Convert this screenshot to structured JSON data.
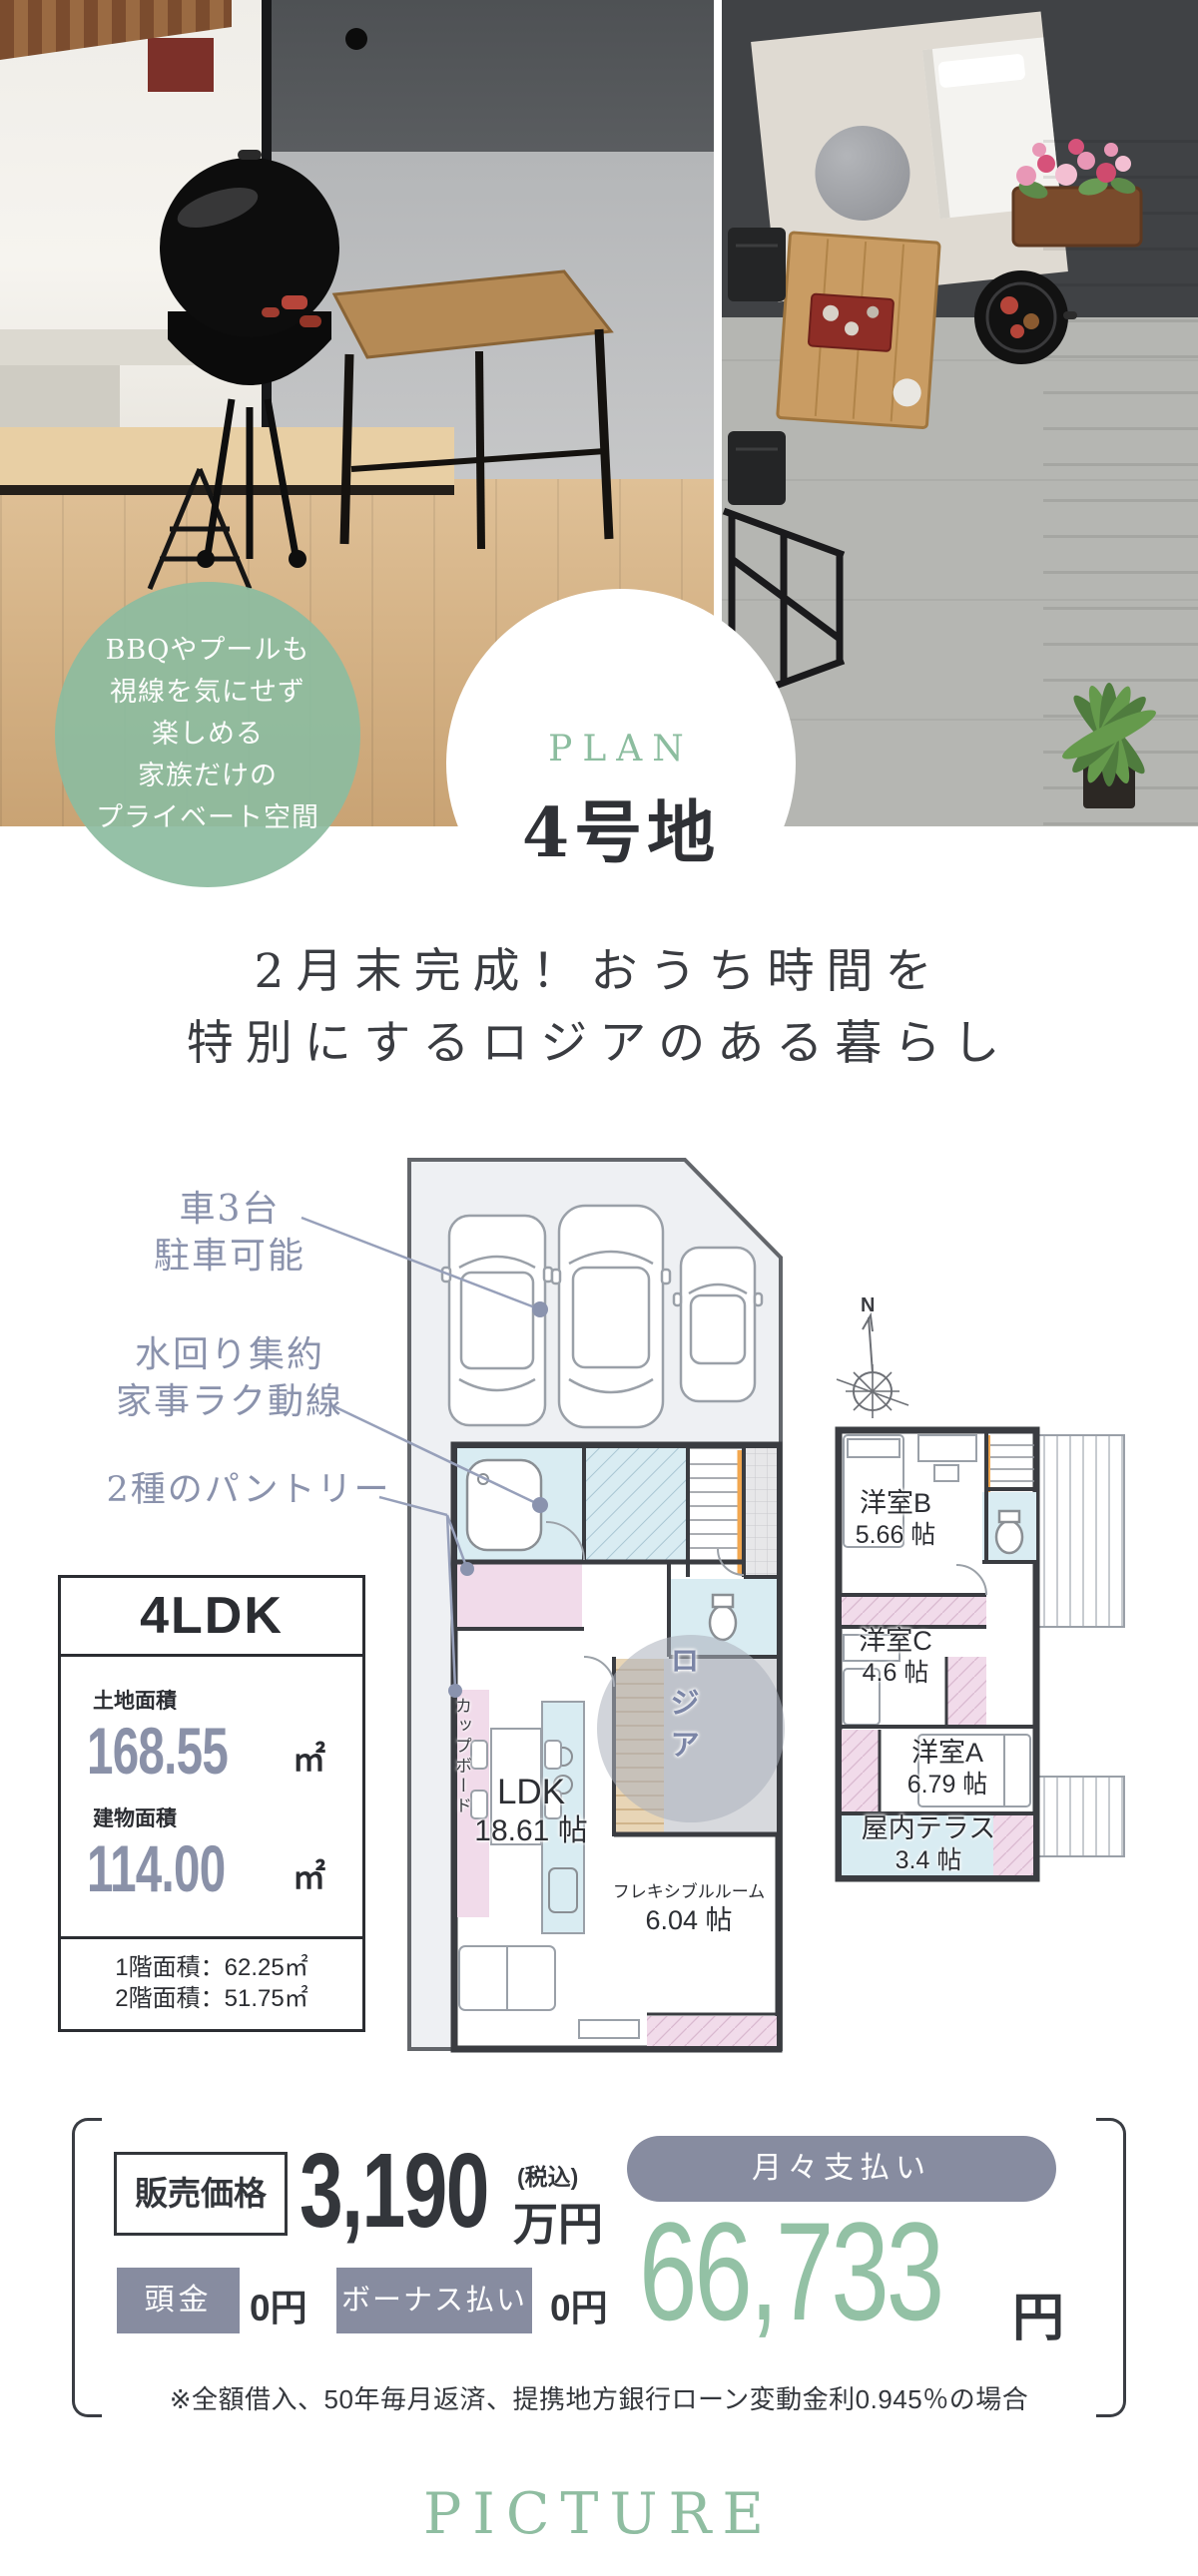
{
  "colors": {
    "sage_green": "#8fbda1",
    "slate_text": "#8a92ac",
    "slate_fill": "#878ca1",
    "dark_text": "#33363b",
    "plan_pink": "#f1dbea",
    "plan_blue": "#d9ecf2",
    "stair_orange": "#f2a74f",
    "number_green": "#93c1a5"
  },
  "hero": {
    "badge_lines": [
      "BBQやプールも",
      "視線を気にせず",
      "楽しめる",
      "家族だけの",
      "プライベート空間"
    ],
    "plan_label": "PLAN",
    "plan_number": "4号地"
  },
  "headline": {
    "line1": "2月末完成！おうち時間を",
    "line2": "特別にするロジアのある暮らし"
  },
  "floorplan": {
    "compass_label": "N",
    "annotations": [
      {
        "line1": "車3台",
        "line2": "駐車可能"
      },
      {
        "line1": "水回り集約",
        "line2": "家事ラク動線"
      },
      {
        "line1": "2種のパントリー",
        "line2": ""
      }
    ],
    "labels_1f": {
      "cupboard": "カップボード",
      "ldk": "LDK",
      "ldk_size": "18.61 帖",
      "flex": "フレキシブルルーム",
      "flex_size": "6.04 帖",
      "loggia": "ロジア"
    },
    "labels_2f": {
      "room_b": "洋室B",
      "room_b_size": "5.66 帖",
      "room_c": "洋室C",
      "room_c_size": "4.6 帖",
      "room_a": "洋室A",
      "room_a_size": "6.79 帖",
      "terrace": "屋内テラス",
      "terrace_size": "3.4 帖"
    }
  },
  "spec": {
    "layout": "4LDK",
    "land_label": "土地面積",
    "land_value": "168.55",
    "land_unit": "㎡",
    "building_label": "建物面積",
    "building_value": "114.00",
    "building_unit": "㎡",
    "floor1_area": "1階面積：62.25㎡",
    "floor2_area": "2階面積：51.75㎡"
  },
  "price": {
    "sale_label": "販売価格",
    "sale_value": "3,190",
    "sale_tax": "(税込)",
    "sale_unit": "万円",
    "deposit_label": "頭金",
    "deposit_value": "0円",
    "bonus_label": "ボーナス払い",
    "bonus_value": "0円",
    "monthly_label": "月々支払い",
    "monthly_value": "66,733",
    "monthly_unit": "円",
    "note": "※全額借入、50年毎月返済、提携地方銀行ローン変動金利0.945％の場合"
  },
  "footer": {
    "title": "PICTURE"
  }
}
